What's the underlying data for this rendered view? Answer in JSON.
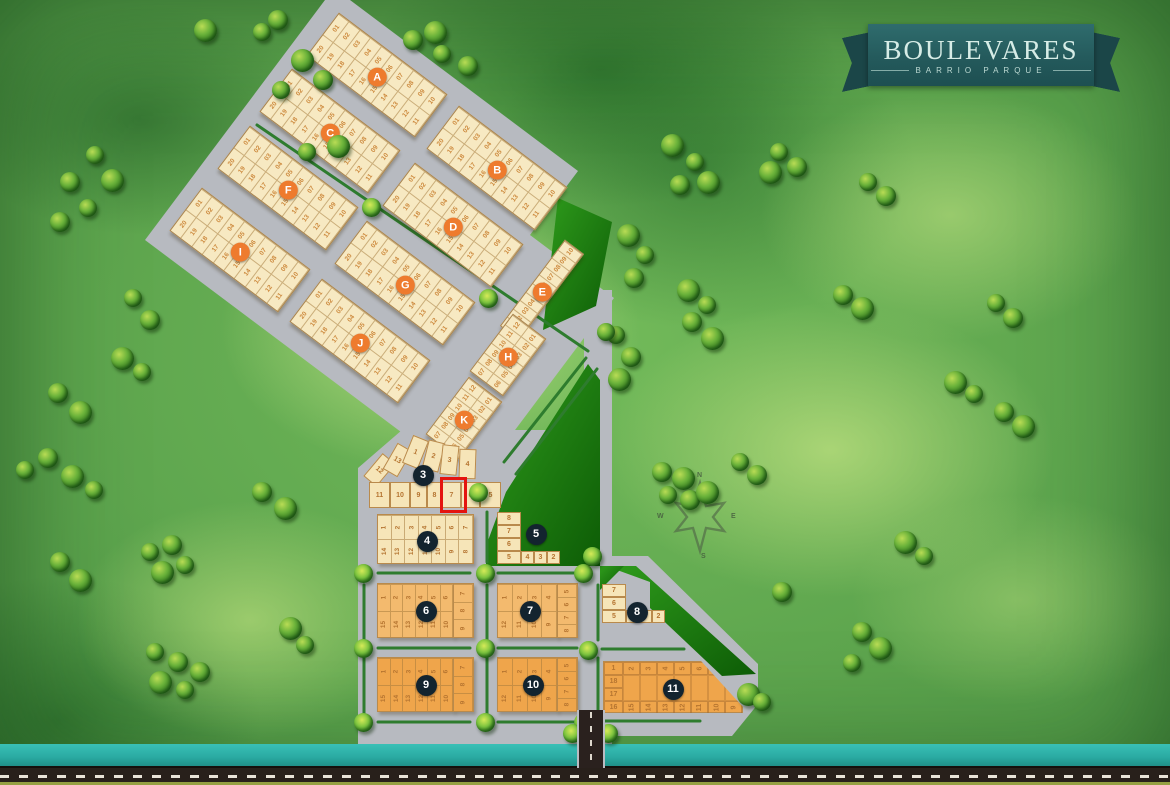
{
  "logo": {
    "title": "BOULEVARES",
    "subtitle": "BARRIO PARQUE"
  },
  "compass": {
    "n": "N",
    "e": "E",
    "s": "S",
    "w": "W"
  },
  "highlight": {
    "block": "3",
    "lot": "7",
    "color": "#e41410"
  },
  "colors": {
    "ribbon": "#245a5c",
    "road": "#b7bac0",
    "park": "#1e7a10",
    "water": "#2db4ac",
    "lot_cream": "#f7e9c2",
    "lot_orange": "#f3ba6e",
    "lot_deep_orange": "#efa54b",
    "letter_badge": "#ee7b2e",
    "number_badge": "#13242f"
  },
  "letter_blocks": [
    {
      "id": "A",
      "label": "A",
      "top": [
        "01",
        "02",
        "03",
        "04",
        "05",
        "06",
        "07",
        "08",
        "09",
        "10"
      ],
      "bottom": [
        "20",
        "19",
        "18",
        "17",
        "16",
        "15",
        "14",
        "13",
        "12",
        "11"
      ]
    },
    {
      "id": "C",
      "label": "C",
      "top": [
        "01",
        "02",
        "03",
        "04",
        "05",
        "06",
        "07",
        "08",
        "09",
        "10"
      ],
      "bottom": [
        "20",
        "19",
        "18",
        "17",
        "16",
        "15",
        "14",
        "13",
        "12",
        "11"
      ]
    },
    {
      "id": "F",
      "label": "F",
      "top": [
        "01",
        "02",
        "03",
        "04",
        "05",
        "06",
        "07",
        "08",
        "09",
        "10"
      ],
      "bottom": [
        "20",
        "19",
        "18",
        "17",
        "16",
        "15",
        "14",
        "13",
        "12",
        "11"
      ]
    },
    {
      "id": "I",
      "label": "I",
      "top": [
        "01",
        "02",
        "03",
        "04",
        "05",
        "06",
        "07",
        "08",
        "09",
        "10"
      ],
      "bottom": [
        "20",
        "19",
        "18",
        "17",
        "16",
        "15",
        "14",
        "13",
        "12",
        "11"
      ]
    },
    {
      "id": "B",
      "label": "B",
      "top": [
        "01",
        "02",
        "03",
        "04",
        "05",
        "06",
        "07",
        "08",
        "09",
        "10"
      ],
      "bottom": [
        "20",
        "19",
        "18",
        "17",
        "16",
        "15",
        "14",
        "13",
        "12",
        "11"
      ]
    },
    {
      "id": "D",
      "label": "D",
      "top": [
        "01",
        "02",
        "03",
        "04",
        "05",
        "06",
        "07",
        "08",
        "09",
        "10"
      ],
      "bottom": [
        "20",
        "19",
        "18",
        "17",
        "16",
        "15",
        "14",
        "13",
        "12",
        "11"
      ]
    },
    {
      "id": "G",
      "label": "G",
      "top": [
        "01",
        "02",
        "03",
        "04",
        "05",
        "06",
        "07",
        "08",
        "09",
        "10"
      ],
      "bottom": [
        "20",
        "19",
        "18",
        "17",
        "16",
        "15",
        "14",
        "13",
        "12",
        "11"
      ]
    },
    {
      "id": "J",
      "label": "J",
      "top": [
        "01",
        "02",
        "03",
        "04",
        "05",
        "06",
        "07",
        "08",
        "09",
        "10"
      ],
      "bottom": [
        "20",
        "19",
        "18",
        "17",
        "16",
        "15",
        "14",
        "13",
        "12",
        "11"
      ]
    },
    {
      "id": "E",
      "label": "E",
      "column": [
        "10",
        "09",
        "08",
        "07",
        "06",
        "05",
        "04",
        "03",
        "02",
        "01"
      ]
    },
    {
      "id": "H",
      "label": "H",
      "left": [
        "12",
        "11",
        "10",
        "09",
        "08",
        "07"
      ],
      "right": [
        "01",
        "02",
        "03",
        "04",
        "05",
        "06"
      ]
    },
    {
      "id": "K",
      "label": "K",
      "left": [
        "12",
        "11",
        "10",
        "09",
        "08",
        "07"
      ],
      "right": [
        "01",
        "02",
        "03",
        "04",
        "05",
        "06"
      ]
    }
  ],
  "number_blocks": [
    {
      "id": "3",
      "label": "3",
      "shape": "wedge",
      "bottom": [
        "11",
        "10",
        "9",
        "8",
        "7",
        "6",
        "5"
      ],
      "fan": [
        "12",
        "13",
        "1",
        "2",
        "3",
        "4"
      ]
    },
    {
      "id": "4",
      "label": "4",
      "shape": "grid2",
      "top": [
        "1",
        "2",
        "3",
        "4",
        "5",
        "6",
        "7"
      ],
      "bottom": [
        "14",
        "13",
        "12",
        "11",
        "10",
        "9",
        "8"
      ]
    },
    {
      "id": "5",
      "label": "5",
      "shape": "lshape",
      "left": [
        "8",
        "7",
        "6",
        "5"
      ],
      "bottom": [
        "4",
        "3",
        "2"
      ]
    },
    {
      "id": "6",
      "label": "6",
      "shape": "gridR",
      "top": [
        "1",
        "2",
        "3",
        "4",
        "5",
        "6"
      ],
      "right": [
        "7",
        "8",
        "9"
      ],
      "bottom": [
        "15",
        "14",
        "13",
        "12",
        "11",
        "10"
      ]
    },
    {
      "id": "7",
      "label": "7",
      "shape": "gridR",
      "top": [
        "1",
        "2",
        "3",
        "4"
      ],
      "right": [
        "5",
        "6",
        "7",
        "8"
      ],
      "bottom": [
        "12",
        "11",
        "10",
        "9"
      ]
    },
    {
      "id": "8",
      "label": "8",
      "shape": "lshape",
      "left": [
        "7",
        "6",
        "5"
      ],
      "bottom": [
        "4",
        "3",
        "2"
      ]
    },
    {
      "id": "9",
      "label": "9",
      "shape": "gridR",
      "top": [
        "1",
        "2",
        "3",
        "4",
        "5",
        "6"
      ],
      "right": [
        "7",
        "8",
        "9"
      ],
      "bottom": [
        "15",
        "14",
        "13",
        "12",
        "11",
        "10"
      ]
    },
    {
      "id": "10",
      "label": "10",
      "shape": "gridR",
      "top": [
        "1",
        "2",
        "3",
        "4"
      ],
      "right": [
        "5",
        "6",
        "7",
        "8"
      ],
      "bottom": [
        "12",
        "11",
        "10",
        "9"
      ]
    },
    {
      "id": "11",
      "label": "11",
      "shape": "block11",
      "left": [
        "1",
        "18",
        "17",
        "16"
      ],
      "top": [
        "2",
        "3",
        "4",
        "5",
        "6",
        "7",
        "8"
      ],
      "bottom": [
        "15",
        "14",
        "13",
        "12",
        "11",
        "10",
        "9"
      ]
    }
  ]
}
